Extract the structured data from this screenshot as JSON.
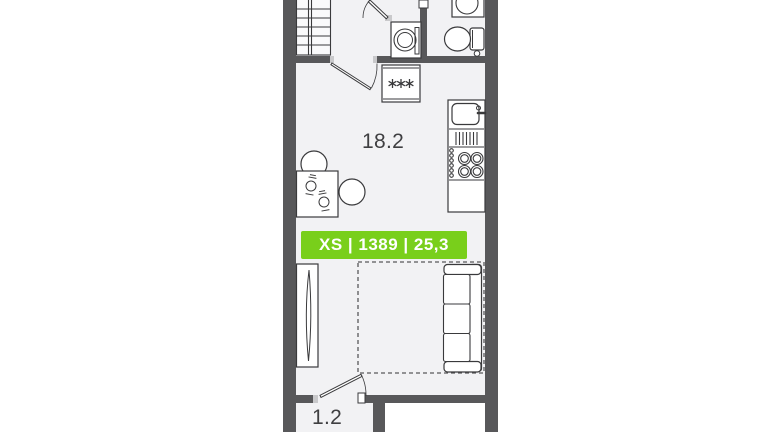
{
  "plan": {
    "badge": {
      "label": "XS | 1389 | 25,3",
      "background": "#79cf1b",
      "text_color": "#ffffff"
    },
    "rooms": [
      {
        "id": "living-room",
        "area_label": "18.2"
      },
      {
        "id": "balcony",
        "area_label": "1.2"
      }
    ],
    "colors": {
      "wall": "#58585a",
      "floor": "#f2f2f4",
      "line": "#3a3a3c",
      "jamb": "#c9c9cb",
      "background": "#ffffff"
    },
    "furniture_icons": [
      "wardrobe-icon",
      "entrance-door-icon",
      "washing-machine-icon",
      "bathroom-sink-icon",
      "toilet-icon",
      "room-door-icon",
      "fridge-icon",
      "kitchen-sink-icon",
      "stove-icon",
      "dining-table-icon",
      "chair-icon",
      "place-setting-icon",
      "closet-icon",
      "bed-outline",
      "sofa-icon",
      "balcony-door-icon"
    ]
  }
}
